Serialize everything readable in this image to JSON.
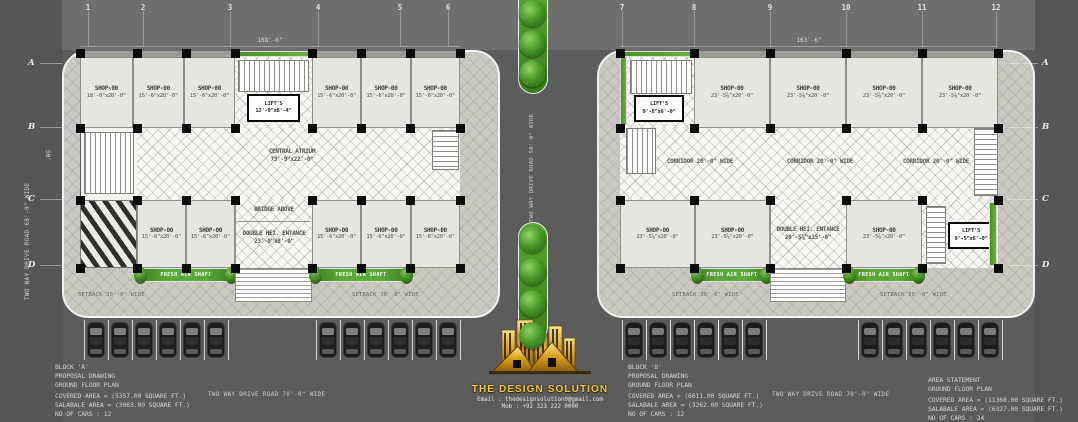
{
  "grid": {
    "left_columns": [
      "1",
      "2",
      "3",
      "4",
      "5",
      "6"
    ],
    "right_columns": [
      "7",
      "8",
      "9",
      "10",
      "11",
      "12"
    ],
    "rows": [
      "A",
      "B",
      "C",
      "D"
    ]
  },
  "dimensions": {
    "left_block_width": "188'-6\"",
    "right_block_width": "163'-6\"",
    "left_block_depth": "50'"
  },
  "left_block": {
    "top_shops_left": [
      {
        "label": "SHOP-00",
        "size": "18'-0\"x20'-0\""
      },
      {
        "label": "SHOP-00",
        "size": "15'-6\"x20'-0\""
      },
      {
        "label": "SHOP-00",
        "size": "15'-6\"x20'-0\""
      }
    ],
    "top_shops_right": [
      {
        "label": "SHOP-00",
        "size": "15'-6\"x20'-0\""
      },
      {
        "label": "SHOP-00",
        "size": "15'-6\"x20'-0\""
      },
      {
        "label": "SHOP-00",
        "size": "15'-6\"x20'-0\""
      }
    ],
    "lift": {
      "label": "LIFT'S",
      "size": "12'-0\"x8'-4\""
    },
    "atrium": {
      "label": "CENTRAL ATRIUM",
      "size": "73'-9\"x22'-0\""
    },
    "bridge_note": "BRIDGE ABOVE",
    "bottom_shops_left": [
      {
        "label": "SHOP-00",
        "size": "15'-6\"x20'-0\""
      },
      {
        "label": "SHOP-00",
        "size": "15'-6\"x20'-0\""
      }
    ],
    "entrance": {
      "label": "DOUBLE HEI. ENTANCE",
      "size": "23'-0\"x8'-0\""
    },
    "bottom_shops_right": [
      {
        "label": "SHOP-00",
        "size": "15'-6\"x20'-0\""
      },
      {
        "label": "SHOP-00",
        "size": "15'-6\"x20'-0\""
      },
      {
        "label": "SHOP-00",
        "size": "15'-6\"x20'-0\""
      }
    ],
    "fresh_air_shaft_label": "FRESH AIR SHAFT",
    "setback_left": "SETBACK 30'-0\" WIDE",
    "setback_right": "SETBACK 30'-0\" WIDE"
  },
  "right_block": {
    "lift_top": {
      "label": "LIFT'S",
      "size": "9'-8\"x6'-0\""
    },
    "top_shops": [
      {
        "label": "SHOP-00",
        "size": "23'-5⅞\"x20'-0\""
      },
      {
        "label": "SHOP-00",
        "size": "23'-5⅞\"x20'-0\""
      },
      {
        "label": "SHOP-00",
        "size": "23'-5⅞\"x20'-0\""
      },
      {
        "label": "SHOP-00",
        "size": "23'-5⅞\"x20'-0\""
      }
    ],
    "corridor_labels": [
      "CORRIDOR 20'-0\" WIDE",
      "CORRIDOR 20'-0\" WIDE",
      "CORRIDOR 20'-0\" WIDE"
    ],
    "bottom_shops_left": [
      {
        "label": "SHOP-00",
        "size": "23'-5⅞\"x20'-0\""
      },
      {
        "label": "SHOP-00",
        "size": "23'-5⅞\"x20'-0\""
      }
    ],
    "entrance": {
      "label": "DOUBLE HEI. ENTANCE",
      "size": "20'-5⅞\"x15'-0\""
    },
    "bottom_shop_right": {
      "label": "SHOP-00",
      "size": "23'-5⅞\"x20'-0\""
    },
    "lift_bottom": {
      "label": "LIFT'S",
      "size": "9'-5\"x6'-0\""
    },
    "fresh_air_shaft_label": "FRESH AIR SHAFT",
    "setback_left": "SETBACK 30'-0\" WIDE",
    "setback_right": "SETBACK 30'-0\" WIDE"
  },
  "roads": {
    "left_vertical": "TWO WAY DRIVE ROAD 60'-0\" WIDE",
    "center_vertical": "TWO WAY DRIVE ROAD 50'-0\" WIDE",
    "bottom_left": "TWO WAY DRIVE ROAD 70'-0\" WIDE",
    "bottom_right": "TWO WAY DRIVE ROAD 70'-0\" WIDE"
  },
  "parking": {
    "left_groups": [
      6,
      6
    ],
    "right_groups": [
      4,
      2,
      6
    ]
  },
  "medians": {
    "top_trees": 3,
    "bottom_trees": 4
  },
  "info_block_a": {
    "line1": "BLOCK 'A'",
    "line2": "PROPOSAL DRAWING",
    "line3": "GROUND FLOOR PLAN",
    "covered": "COVERED AREA = (5357.00 SQUARE FT.)",
    "salable": "SALABALE AREA = (3063.00 SQUARE FT.)",
    "cars": "NO OF CARS : 12"
  },
  "info_block_b": {
    "line1": "BLOCK 'B'",
    "line2": "PROPOSAL DRAWING",
    "line3": "GROUND FLOOR PLAN",
    "covered": "COVERED AREA = (6011.00 SQUARE FT.)",
    "salable": "SALABALE AREA = (3262.00 SQUARE FT.)",
    "cars": "NO OF CARS : 12"
  },
  "area_statement": {
    "line1": "AREA STATEMENT",
    "line2": "GROUND FLOOR PLAN",
    "covered": "COVERED AREA = (11368.00 SQUARE FT.)",
    "salable": "SALABALE AREA = (6327.00 SQUARE FT.)",
    "cars": "NO OF CARS : 24"
  },
  "logo": {
    "name": "THE DESIGN SOLUTION",
    "email": "Email : thedesignsolution0@gmail.com",
    "mobile": "Mob : +92 323 222 0000"
  },
  "colors": {
    "road": "#5c5c5c",
    "plot": "#c9c9c2",
    "building": "#f3f3ef",
    "shop_fill": "#e6e6e1",
    "green": "#4c8f27",
    "accent_gold": "#e8b33a",
    "column": "#0c0c0c"
  }
}
